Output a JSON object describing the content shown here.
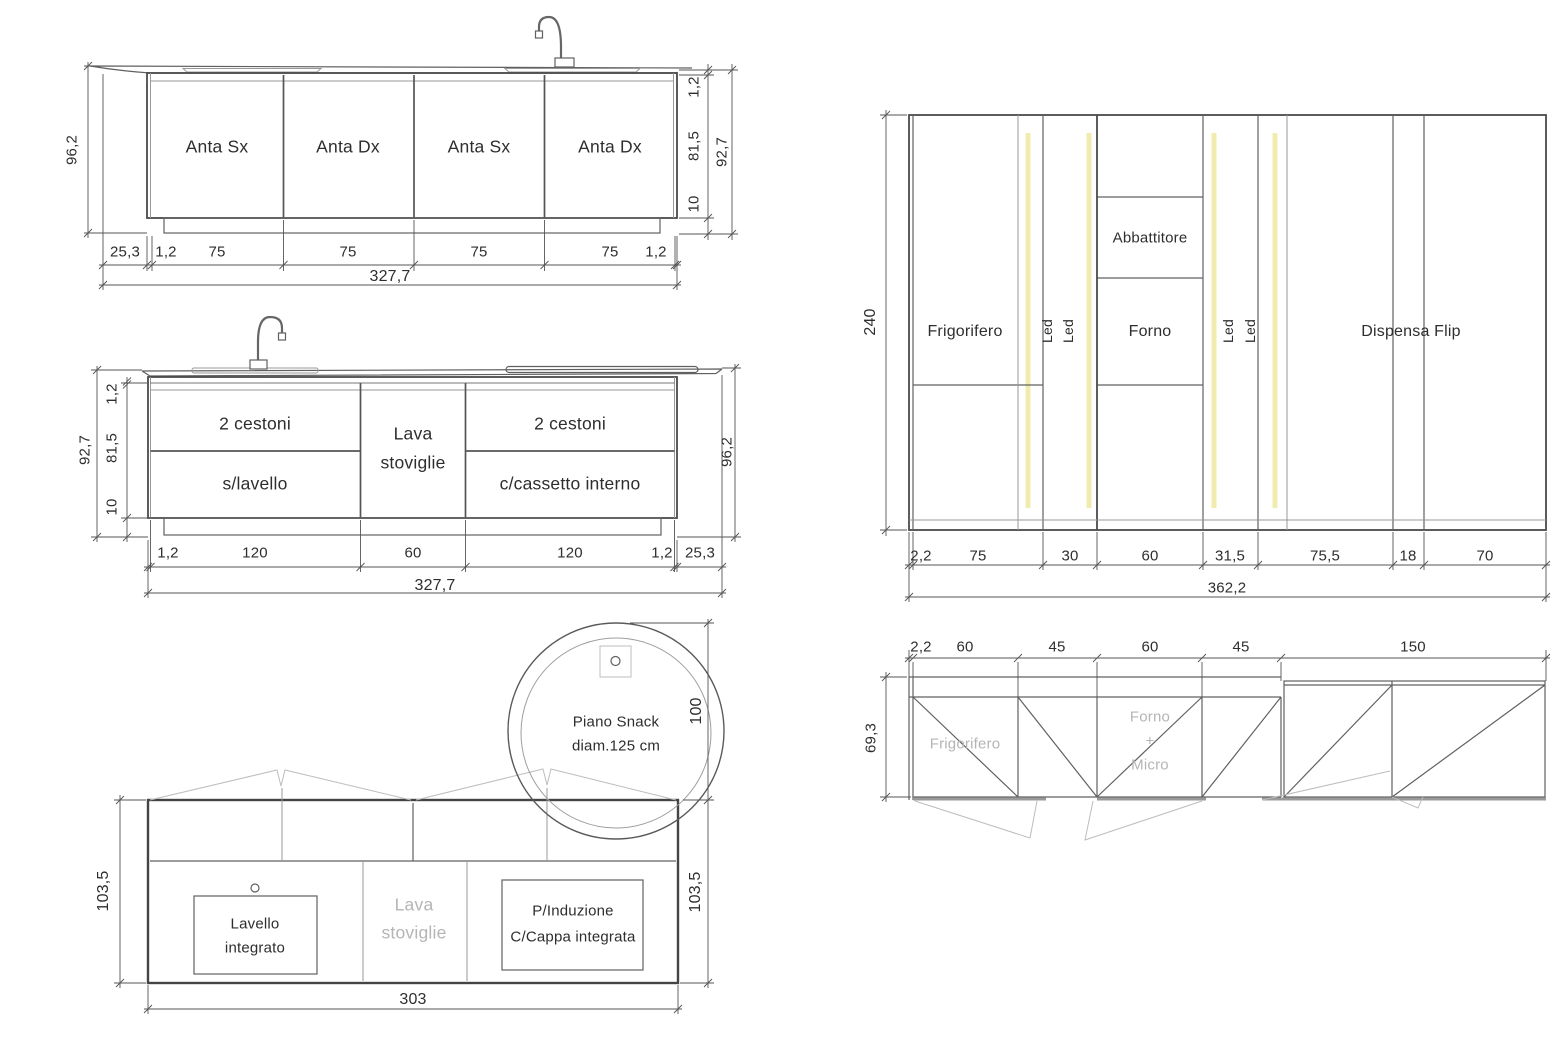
{
  "island_front_elevation": {
    "doors": [
      "Anta Sx",
      "Anta Dx",
      "Anta Sx",
      "Anta Dx"
    ],
    "dims_bottom": [
      "25,3",
      "1,2",
      "75",
      "75",
      "75",
      "75",
      "1,2"
    ],
    "dim_total_width": "327,7",
    "dim_height_overall": "96,2",
    "dims_right": [
      "1,2",
      "81,5",
      "10"
    ],
    "dim_height_cabinet": "92,7"
  },
  "island_back_elevation": {
    "sections": [
      {
        "top": "2 cestoni",
        "bottom": "s/lavello"
      },
      {
        "top": "Lava",
        "bottom": "stoviglie"
      },
      {
        "top": "2 cestoni",
        "bottom": "c/cassetto interno"
      }
    ],
    "dims_bottom": [
      "1,2",
      "120",
      "60",
      "120",
      "1,2",
      "25,3"
    ],
    "dim_total_width": "327,7",
    "dims_left": [
      "1,2",
      "81,5",
      "10"
    ],
    "dim_height_cabinet": "92,7",
    "dim_height_overall": "96,2"
  },
  "island_plan": {
    "snack_label": [
      "Piano Snack",
      "diam.125 cm"
    ],
    "sink_label": [
      "Lavello",
      "integrato"
    ],
    "dishwasher_label": [
      "Lava",
      "stoviglie"
    ],
    "hob_label": [
      "P/Induzione",
      "C/Cappa integrata"
    ],
    "dim_width": "303",
    "dim_depth_left": "103,5",
    "dim_depth_right": "103,5",
    "dim_snack": "100"
  },
  "tall_units_elevation": {
    "fridge": "Frigorifero",
    "led": "Led",
    "blast_chiller": "Abbattitore",
    "oven": "Forno",
    "pantry": "Dispensa Flip",
    "dims_bottom": [
      "2,2",
      "75",
      "30",
      "60",
      "31,5",
      "75,5",
      "18",
      "70"
    ],
    "dim_total_width": "362,2",
    "dim_height": "240"
  },
  "tall_units_plan": {
    "fridge": "Frigorifero",
    "oven_micro": [
      "Forno",
      "+",
      "Micro"
    ],
    "dims_top": [
      "2,2",
      "60",
      "45",
      "60",
      "45",
      "150"
    ],
    "dim_depth": "69,3"
  },
  "colors": {
    "led_strip": "#f1ecae"
  }
}
